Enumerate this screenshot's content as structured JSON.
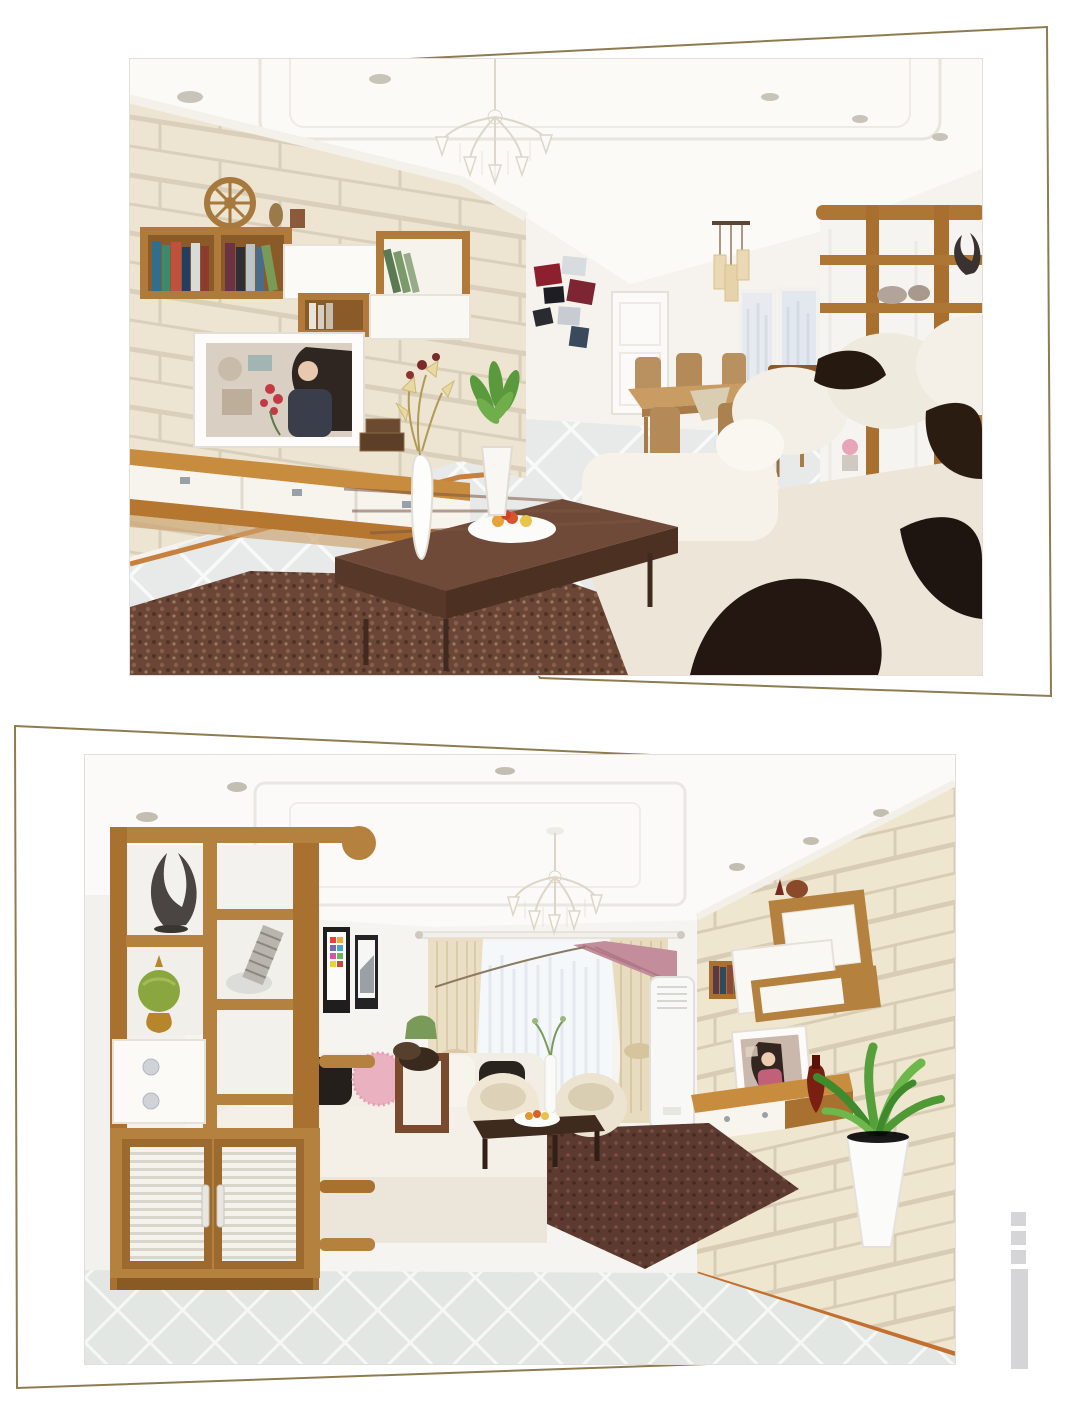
{
  "page": {
    "background": "#ffffff",
    "width": 1080,
    "height": 1416,
    "kind": "article photo layout, no visible text"
  },
  "frames": {
    "stroke_color": "#8f7b50",
    "stroke_width": 2,
    "top": {
      "points": "250,67 1047,27 1051,696 540,678",
      "visible_sides": "top-right diagonal, right edge, bottom-right diagonal"
    },
    "bottom": {
      "points": "15,726 870,765 880,1358 17,1388",
      "visible_sides": "top-left diagonal, left edge, bottom-left diagonal"
    }
  },
  "photos": [
    {
      "id": "photo-1",
      "x": 130,
      "y": 59,
      "width": 852,
      "height": 616,
      "alt": "Render of a living room: beige brick TV wall with wood and white floating wall units and bookshelves, TV showing a woman with red flowers, floating TV console, walnut coffee table with fruit bowl and tall white flower vase, brown shag rug, white sectional sofa with dark brown pillows and throw, dining table with wooden chairs, pendant lamp, crystal chandelier, white diamond-tile floor"
    },
    {
      "id": "photo-2",
      "x": 85,
      "y": 755,
      "width": 870,
      "height": 609,
      "alt": "Render of a living room: tall wooden room-divider display shelf with shell sculpture, leaning-tower photo, green sphere ornament, white drawers and louvered shoe cabinet; white sofa with black and pink pillows; cream curtains with mauve valance over a sheer window; two cream tub chairs and dark coffee table on a maroon rug; beige brick TV wall with floating wood and white cabinets, wall TV, amber vase, floor AC unit and a green plant in a tall white planter; crystal chandelier and grey diamond-tile floor"
    }
  ],
  "watermark": {
    "color": "#d5d5d7",
    "squares": 3,
    "bar": 1,
    "position": "bottom-right"
  },
  "palette": {
    "frame_gold": "#8f7b50",
    "wood": "#b5813f",
    "wood_dark": "#8a5a24",
    "brick_wall": "#ede5d1",
    "brick_groove": "#d9cfba",
    "floor_tile": "#e7eae8",
    "rug_brown": "#6b4636",
    "rug_maroon": "#5d3a30",
    "sofa_cream": "#f2eee6",
    "pillow_dark": "#241a12",
    "valance_mauve": "#c38d9b",
    "plant_green": "#5aa33c",
    "accent_red": "#c23b44",
    "watermark_grey": "#d5d5d7"
  }
}
